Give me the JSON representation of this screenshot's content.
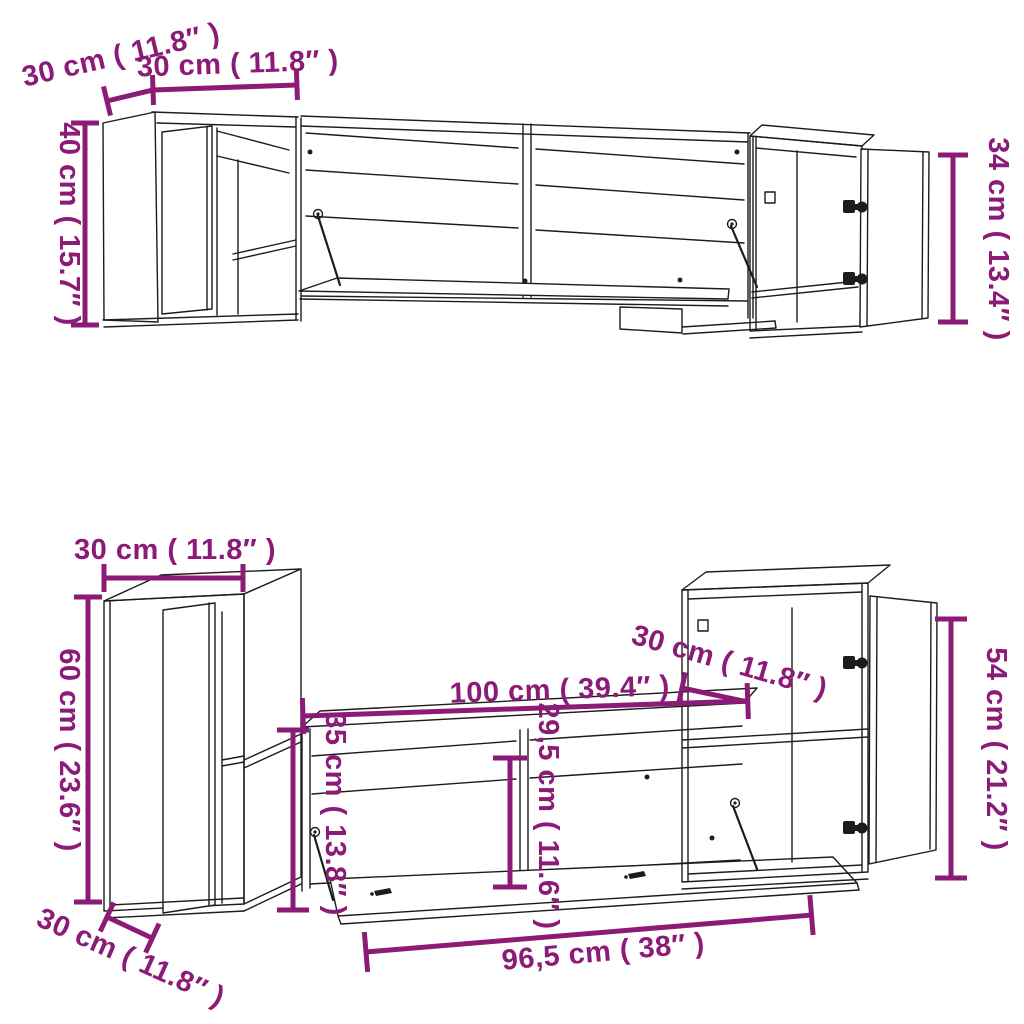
{
  "colors": {
    "dimension_accent": "#8B1B76",
    "drawing_line": "#1C1C1C",
    "background": "#FFFFFF"
  },
  "diagram_top": {
    "name": "upper wall cabinet arrangement",
    "dims": {
      "side_cabinet_depth": "30 cm ( 11.8″ )",
      "side_cabinet_width": "30 cm ( 11.8″ )",
      "left_cabinet_height": "40 cm ( 15.7″ )",
      "right_cabinet_height": "34 cm ( 13.4″ )"
    }
  },
  "diagram_bottom": {
    "name": "lower wall cabinet arrangement",
    "dims": {
      "left_cabinet_width": "30 cm ( 11.8″ )",
      "left_cabinet_height": "60 cm ( 23.6″ )",
      "tv_bench_width": "100 cm ( 39.4″ )",
      "right_cabinet_depth": "30 cm ( 11.8″ )",
      "right_cabinet_height": "54 cm ( 21.2″ )",
      "tv_bench_height": "35 cm ( 13.8″ )",
      "flap_opening_height": "29,5 cm ( 11.6″ )",
      "flap_door_width": "96,5 cm ( 38″ )",
      "left_cabinet_depth": "30 cm ( 11.8″ )"
    }
  }
}
